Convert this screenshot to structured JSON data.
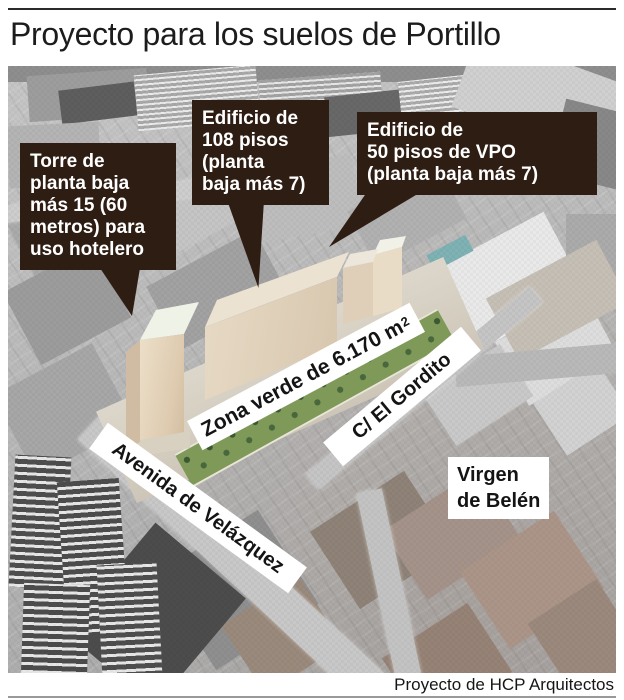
{
  "header": {
    "title": "Proyecto para los suelos de Portillo"
  },
  "footer": {
    "credit": "Proyecto de HCP Arquitectos"
  },
  "colors": {
    "callout_bg": "#2e1d13",
    "callout_text": "#ffffff",
    "label_bg": "#ffffff",
    "render_beige": "#e7dac5",
    "green_zone": "#7e9958"
  },
  "callouts": [
    {
      "id": "hotel-tower",
      "text": "Torre de\nplanta baja\nmás 15 (60\nmetros) para\nuso hotelero"
    },
    {
      "id": "building-108",
      "text": "Edificio de\n108 pisos\n(planta\nbaja más 7)"
    },
    {
      "id": "building-vpo",
      "text": "Edificio de\n50 pisos de VPO\n(planta baja más 7)"
    }
  ],
  "map_labels": {
    "green_zone": {
      "text": "Zona verde de 6.170 m",
      "superscript": "2"
    },
    "street_gordito": "C/ El Gordito",
    "street_avenida": "Avenida de Velázquez",
    "district": "Virgen\nde Belén"
  }
}
